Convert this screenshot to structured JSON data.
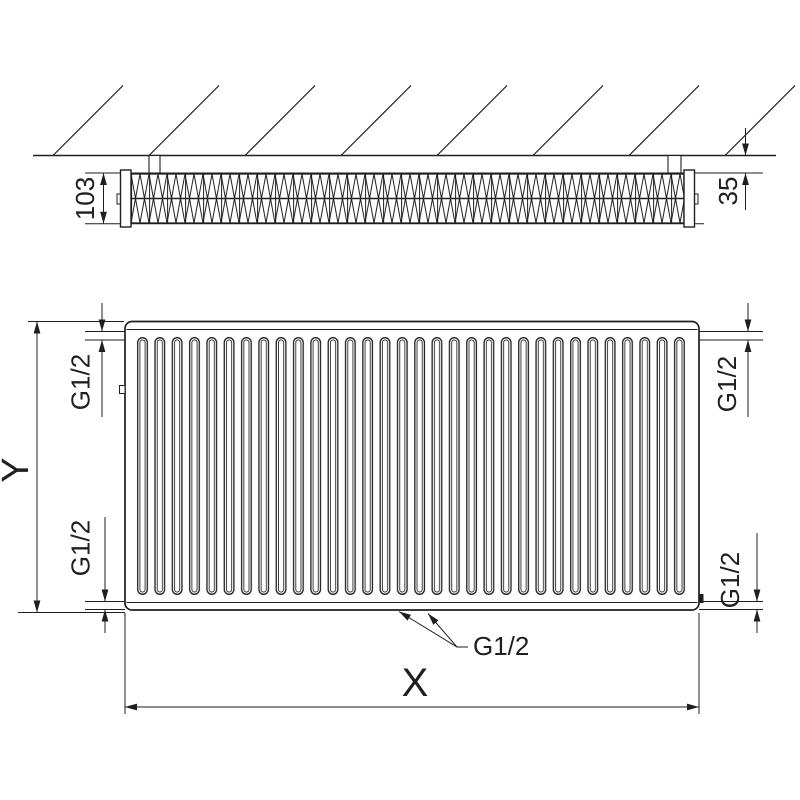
{
  "drawing": {
    "type": "radiator-technical-drawing",
    "colors": {
      "line": "#1f1f1f",
      "background": "#ffffff"
    },
    "top_view": {
      "depth_label": "103",
      "wall_distance_label": "35"
    },
    "front_view": {
      "height_label": "Y",
      "width_label": "X",
      "connections": {
        "top_left": "G1/2",
        "top_right": "G1/2",
        "bottom_left": "G1/2",
        "bottom_right": "G1/2",
        "bottom_center": "G1/2"
      }
    }
  }
}
